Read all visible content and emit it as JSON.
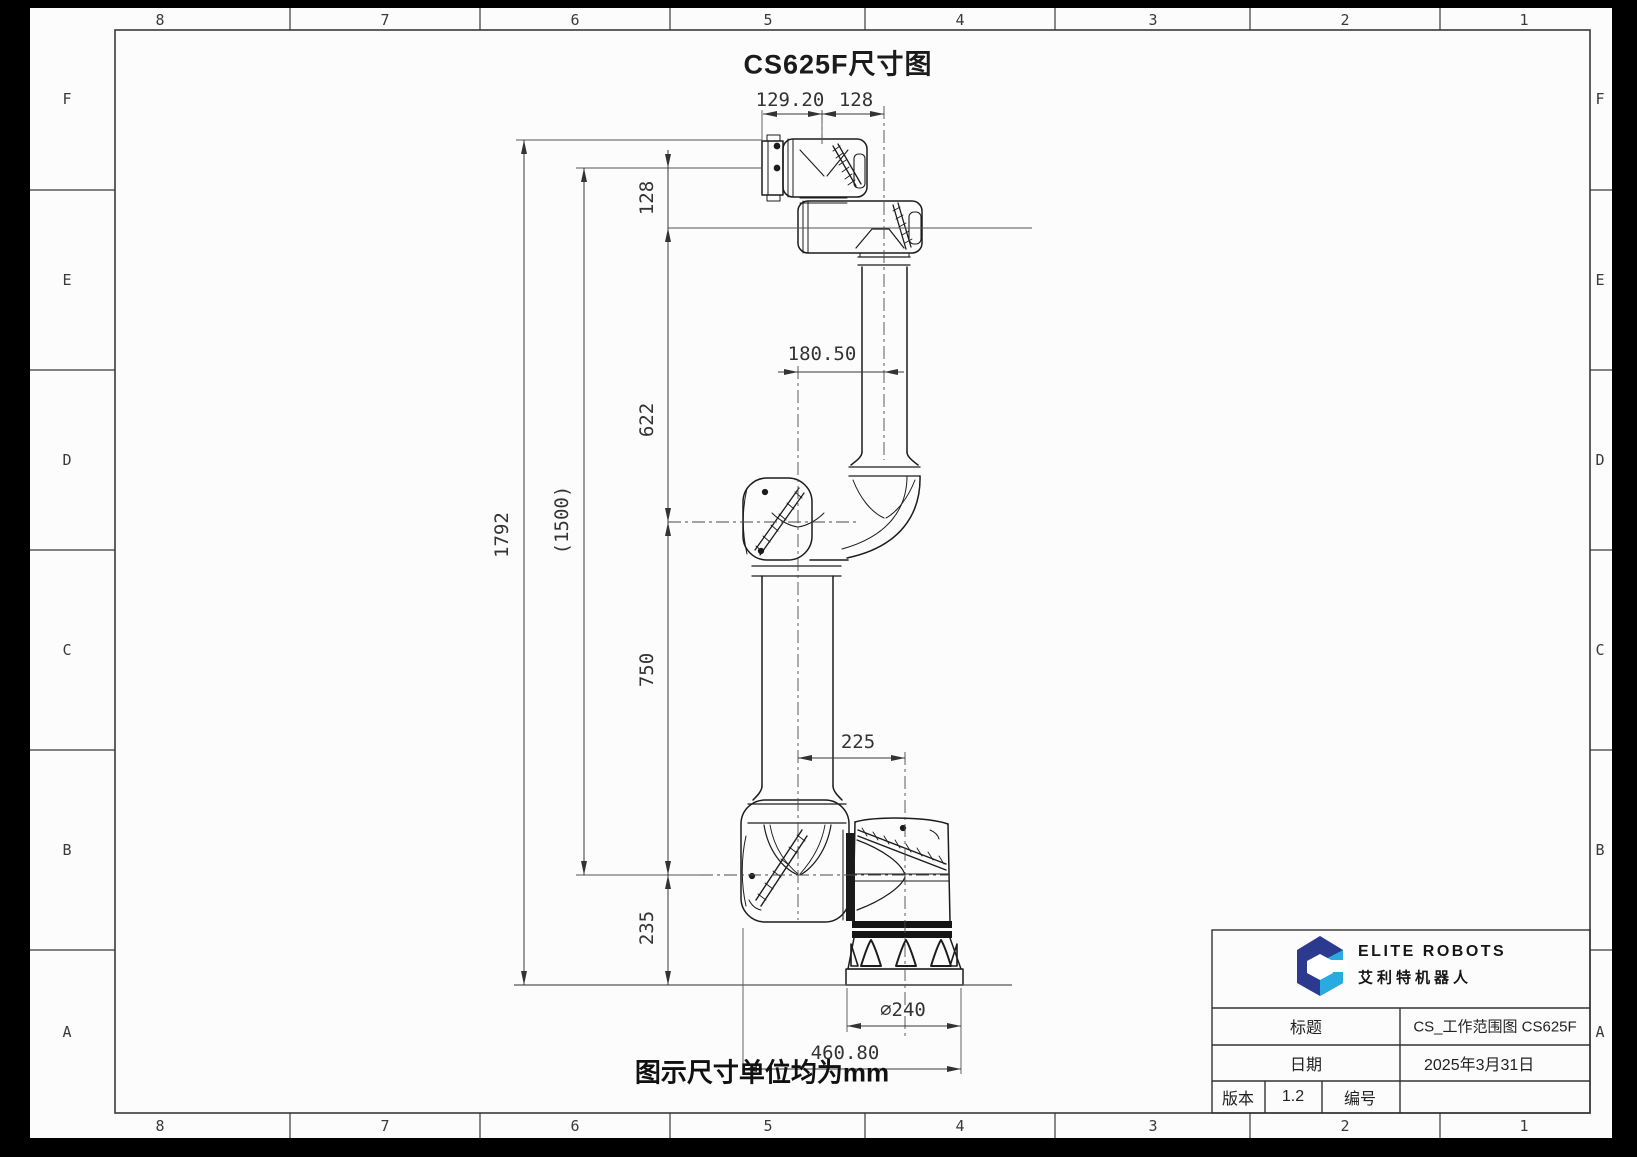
{
  "sheet": {
    "title": "CS625F尺寸图",
    "note": "图示尺寸单位均为mm",
    "grid": {
      "columns": [
        "8",
        "7",
        "6",
        "5",
        "4",
        "3",
        "2",
        "1"
      ],
      "rows": [
        "F",
        "E",
        "D",
        "C",
        "B",
        "A"
      ]
    }
  },
  "dimensions": {
    "flange_to_wrist3": "129.20",
    "wrist3_to_forearm": "128",
    "flange_to_wrist2": "128",
    "wrist2_to_elbow": "622",
    "elbow_to_shoulder": "750",
    "shoulder_to_base": "235",
    "total_height": "1792",
    "working_height": "(1500)",
    "elbow_offset": "180.50",
    "shoulder_offset": "225",
    "base_diameter": "∅240",
    "footprint_width": "460.80"
  },
  "title_block": {
    "brand": {
      "name": "ELITE ROBOTS",
      "name_cn": "艾利特机器人",
      "colors": {
        "navy": "#2b3a8f",
        "cyan": "#29abe2"
      }
    },
    "title_label": "标题",
    "title_value": "CS_工作范围图 CS625F",
    "date_label": "日期",
    "date_value": "2025年3月31日",
    "version_label": "版本",
    "version_value": "1.2",
    "number_label": "编号",
    "number_value": ""
  }
}
